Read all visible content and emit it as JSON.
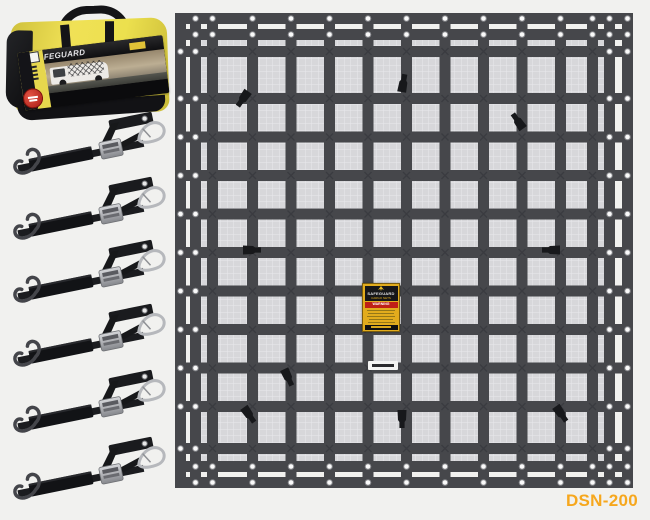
{
  "page": {
    "background": "#f1f1ef"
  },
  "product": {
    "sku": "DSN-200",
    "sku_color": "#F6A71D"
  },
  "bag": {
    "brand": "SAFEGUARD",
    "body_color": "#ecdc4e",
    "badge_color": "#c0251c"
  },
  "net": {
    "strap_color": "#46474b",
    "mesh_color": "#d7d7da",
    "mesh_line_color": "#e9e9ec",
    "center_label": {
      "brand": "SAFEGUARD",
      "subtitle": "CARGO NETS",
      "warning": "WARNING"
    }
  },
  "straps": {
    "count": 6
  }
}
